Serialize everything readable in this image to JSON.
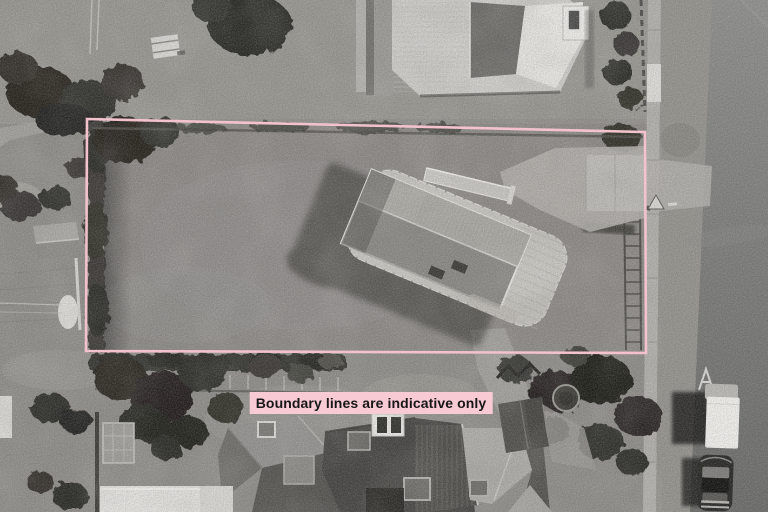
{
  "overlay": {
    "disclaimer_text": "Boundary lines are indicative only"
  },
  "colors": {
    "boundary-pink": "#f3c2cc",
    "label-bg": "#f8cad4",
    "label-text": "#171717",
    "grass": "#8e8c88",
    "grass-top": "#9a9893",
    "footpath": "#b2b0ac",
    "berm": "#94928d",
    "road-light": "#8d8d8b",
    "road-dark": "#6a6a68",
    "concrete": "#b1afab",
    "house-deck": "#c7c5c0",
    "house-roof-upper": "#a9a7a2",
    "house-roof-lower": "#8b8985",
    "roof-white": "#e9e8e5",
    "roof-dark": "#4a4946",
    "tree-dark": "#25241f",
    "shadow": "#1b1b19"
  }
}
